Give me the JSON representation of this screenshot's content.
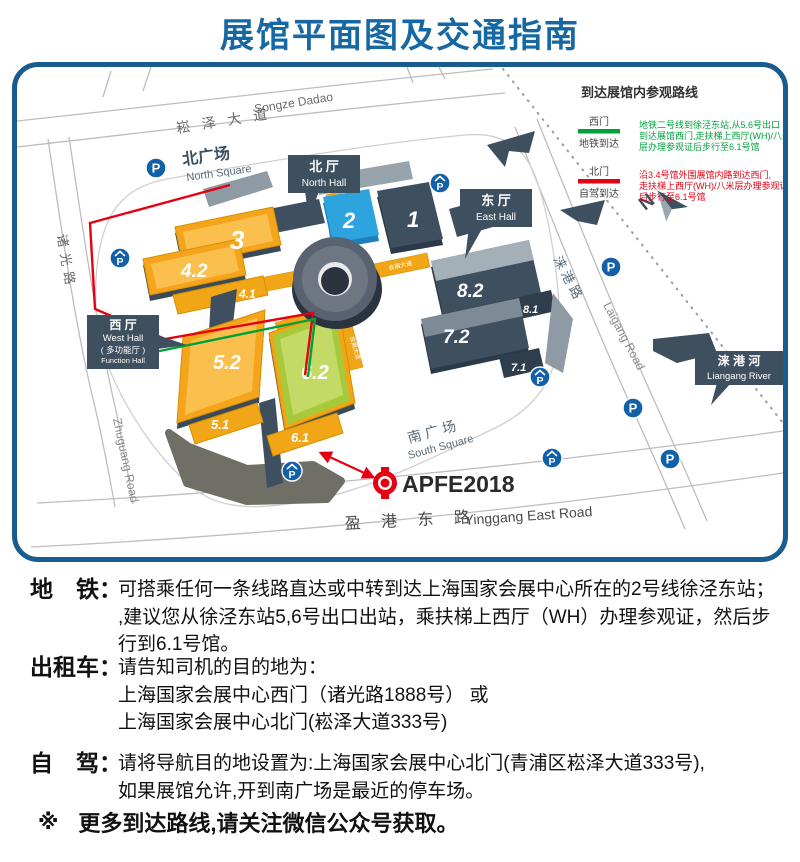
{
  "title": "展馆平面图及交通指南",
  "legend": {
    "title": "到达展馆内参观路线",
    "metro": {
      "gate": "西门",
      "mode": "地铁到达",
      "color": "#00a13a",
      "lines": [
        "地铁二号线到徐泾东站,从5.6号出口",
        "到达展馆西门,走扶梯上西厅(WH)/八米",
        "层办理参观证后步行至6.1号馆"
      ]
    },
    "drive": {
      "gate": "北门",
      "mode": "自驾到达",
      "color": "#e60012",
      "lines": [
        "沿3.4号馆外围展馆内路到达西门,",
        "走扶梯上西厅(WH)/八米层办理参观证",
        "后步行至6.1号馆"
      ]
    }
  },
  "map": {
    "roads": {
      "songze_cn": "崧 泽 大 道",
      "songze_en": "Songze Dadao",
      "zhuguang_cn": "诸光路",
      "zhuguang_en": "Zhuguang Road",
      "laigang_cn": "涞 港 路",
      "laigang_en": "Laigang Road",
      "yinggang_cn": "盈 港 东 路",
      "yinggang_en": "Yinggang East Road"
    },
    "squares": {
      "north_cn": "北广场",
      "north_en": "North Square",
      "south_cn": "南 广 场",
      "south_en": "South Square"
    },
    "callouts": {
      "north_cn": "北 厅",
      "north_en": "North Hall",
      "east_cn": "东 厅",
      "east_en": "East Hall",
      "west_cn": "西 厅",
      "west_en": "West Hall",
      "west_sub_cn": "( 多功能厅 )",
      "west_sub_en": "Function Hall",
      "river_cn": "涞 港 河",
      "river_en": "Liangang River"
    },
    "halls": {
      "h1": "1",
      "h2": "2",
      "h3": "3",
      "h41": "4.1",
      "h42": "4.2",
      "h51": "5.1",
      "h52": "5.2",
      "h61": "6.1",
      "h62": "6.2",
      "h71": "7.1",
      "h72": "7.2",
      "h81": "8.1",
      "h82": "8.2"
    },
    "corridor": "会展大道",
    "compass": "N",
    "parking_letter": "P",
    "event_logo": "APFE2018"
  },
  "sections": [
    {
      "label": "地　铁：",
      "lines": [
        "可搭乘任何一条线路直达或中转到达上海国家会展中心所在的2号线徐泾东站；",
        ",建议您从徐泾东站5,6号出口出站，乘扶梯上西厅（WH）办理参观证，然后步",
        "行到6.1号馆。"
      ]
    },
    {
      "label": "出租车：",
      "lines": [
        "请告知司机的目的地为：",
        "上海国家会展中心西门（诸光路1888号） 或",
        "上海国家会展中心北门(崧泽大道333号)"
      ]
    },
    {
      "label": "自　驾：",
      "lines": [
        "请将导航目的地设置为:上海国家会展中心北门(青浦区崧泽大道333号),",
        "如果展馆允许,开到南广场是最近的停车场。"
      ]
    }
  ],
  "note": {
    "mark": "※",
    "text": "更多到达路线,请关注微信公众号获取。"
  }
}
